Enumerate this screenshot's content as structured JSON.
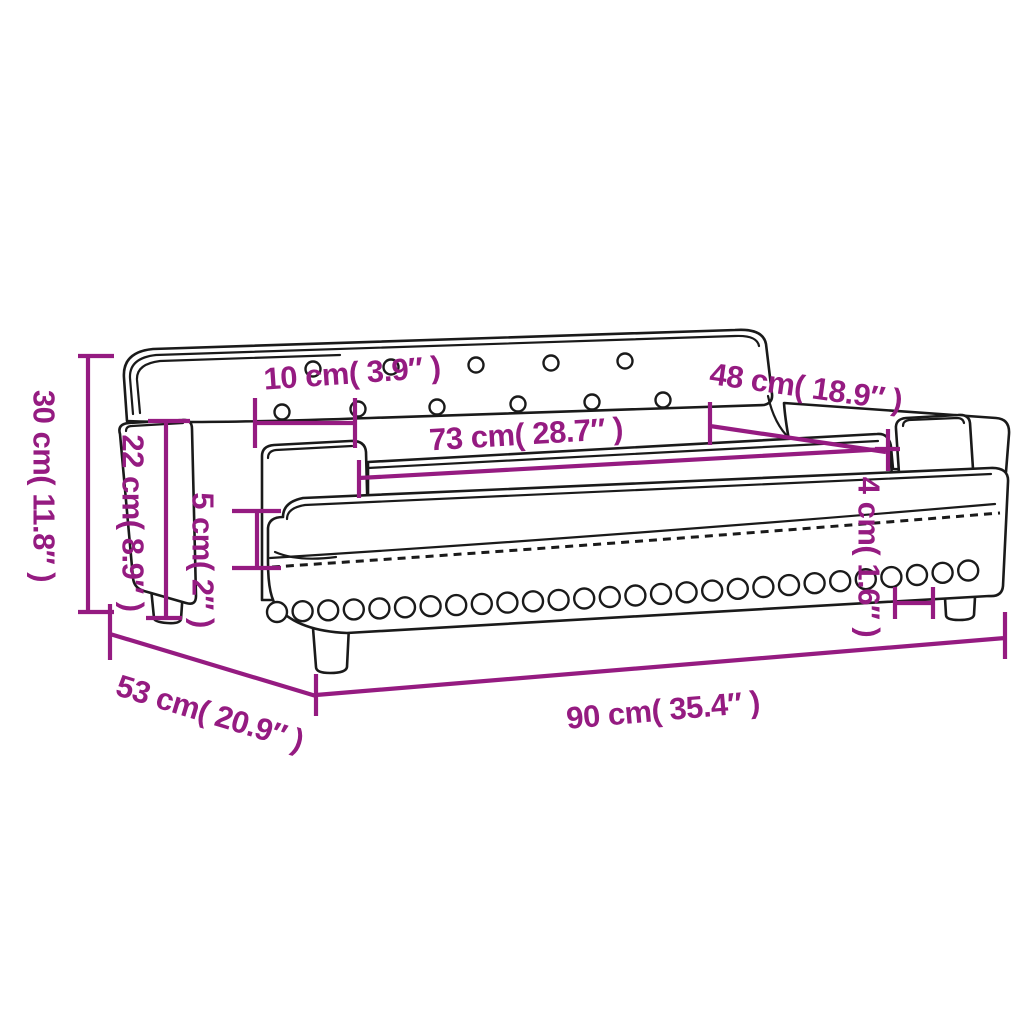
{
  "title": "Sofa dimension diagram",
  "product": "kids sofa with armrests, tufted backrest, studded base and four legs",
  "colors": {
    "accent": "#951B81",
    "line": "#1a1a1a",
    "background": "#ffffff"
  },
  "dimensions": {
    "overall_height": {
      "label": "30 cm( 11.8″ )",
      "cm": 30,
      "inch": 11.8
    },
    "armrest_height": {
      "label": "22 cm( 8.9″ )",
      "cm": 22,
      "inch": 8.9
    },
    "armrest_width": {
      "label": "10 cm( 3.9″ )",
      "cm": 10,
      "inch": 3.9
    },
    "seat_length": {
      "label": "73 cm( 28.7″ )",
      "cm": 73,
      "inch": 28.7
    },
    "inner_length": {
      "label": "48 cm( 18.9″ )",
      "cm": 48,
      "inch": 18.9
    },
    "cushion_thickness": {
      "label": "5 cm( 2″ )",
      "cm": 5,
      "inch": 2
    },
    "rail_thickness": {
      "label": "4 cm( 1.6″ )",
      "cm": 4,
      "inch": 1.6
    },
    "overall_depth": {
      "label": "53 cm( 20.9″ )",
      "cm": 53,
      "inch": 20.9
    },
    "overall_width": {
      "label": "90 cm( 35.4″ )",
      "cm": 90,
      "inch": 35.4
    }
  }
}
